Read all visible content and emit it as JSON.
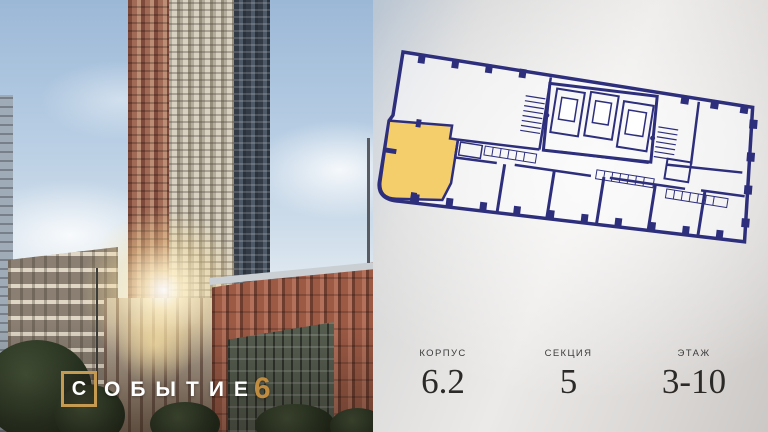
{
  "logo": {
    "boxed_letter": "С",
    "rest": "ОБЫТИЕ",
    "number": "6"
  },
  "info": {
    "columns": [
      {
        "label": "КОРПУС",
        "value": "6.2"
      },
      {
        "label": "СЕКЦИЯ",
        "value": "5"
      },
      {
        "label": "ЭТАЖ",
        "value": "3-10"
      }
    ]
  },
  "floorplan": {
    "highlighted_unit": "corner-unit-left",
    "highlight_color": "#F5CE6C",
    "line_color": "#2E2F7C"
  },
  "colors": {
    "logo_gold": "#C79A52",
    "logo_number_gold": "#C08C3F",
    "panel_background": "#ECEAE8",
    "value_text": "#2C2A28"
  }
}
